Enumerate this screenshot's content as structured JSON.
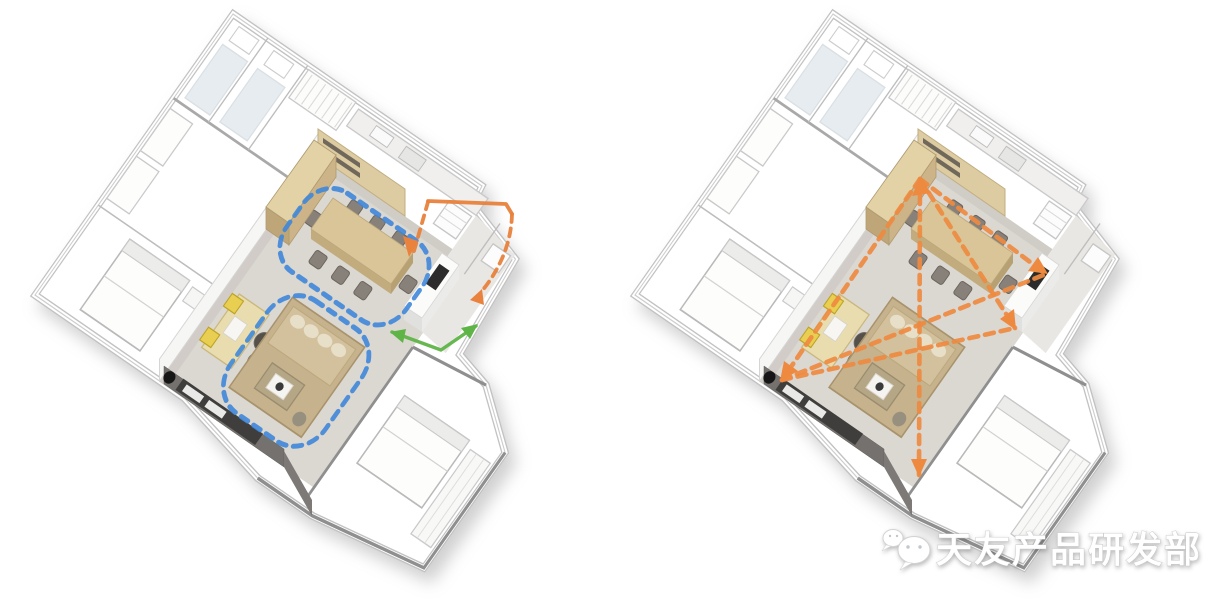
{
  "watermark": {
    "text": "天友产品研发部",
    "icon": "wechat-icon"
  },
  "colors": {
    "background": "#ffffff",
    "loop_blue": "#3f87d9",
    "route_orange": "#e8823c",
    "route_green": "#5fb448",
    "sightline_orange": "#ee8a40",
    "floor_tan": "#d8c498",
    "wall_beige": "#ddcba1",
    "wall_gray": "#bdbdbd",
    "dark_wall_gray": "#74716e"
  }
}
